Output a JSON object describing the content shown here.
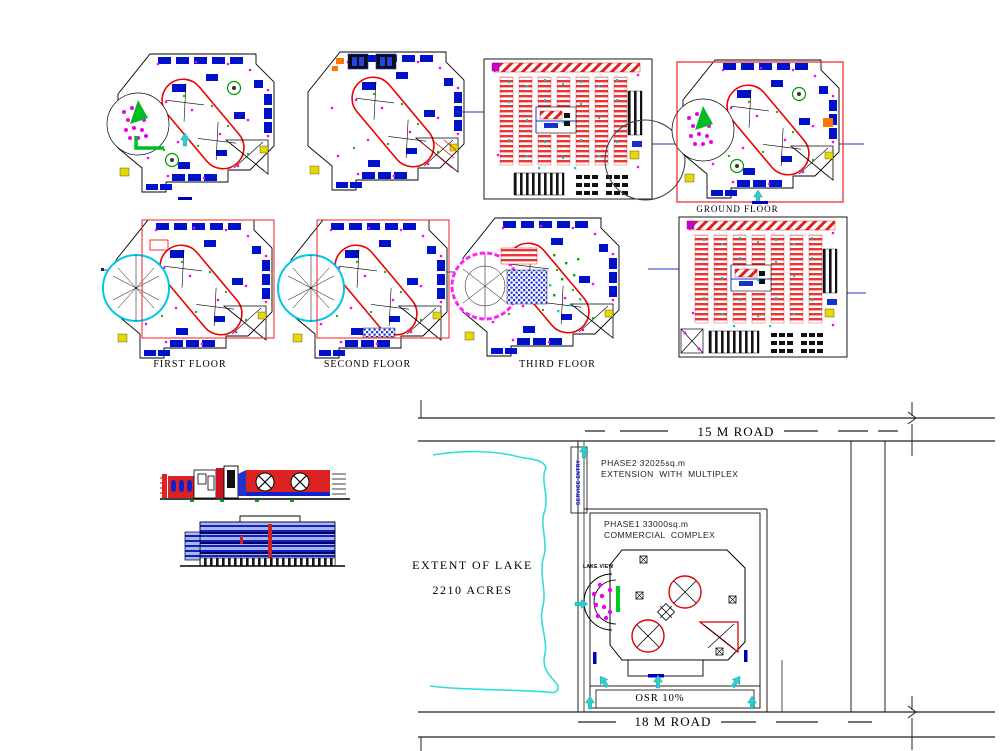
{
  "floors": {
    "first": "FIRST FLOOR",
    "second": "SECOND FLOOR",
    "third": "THIRD FLOOR",
    "ground": "GROUND FLOOR"
  },
  "site": {
    "road_top": "15 M ROAD",
    "road_bottom": "18 M ROAD",
    "phase2_line1": "PHASE2 32025sq.m",
    "phase2_line2": "EXTENSION  WITH  MULTIPLEX",
    "phase1_line1": "PHASE1 33000sq.m",
    "phase1_line2": "COMMERCIAL  COMPLEX",
    "service_entry": "SERVICE ENTRY",
    "lake_view": "LAKE VIEW",
    "osr": "OSR 10%"
  },
  "lake": {
    "line1": "EXTENT OF LAKE",
    "line2": "2210 ACRES"
  },
  "colors": {
    "cad_blue": "#0011cc",
    "cad_red": "#dd0000",
    "magenta": "#ff00ff",
    "cyan_arrow": "#33cccc",
    "lake_cyan": "#33dddd",
    "green": "#00bb22",
    "orange": "#ff7700"
  }
}
